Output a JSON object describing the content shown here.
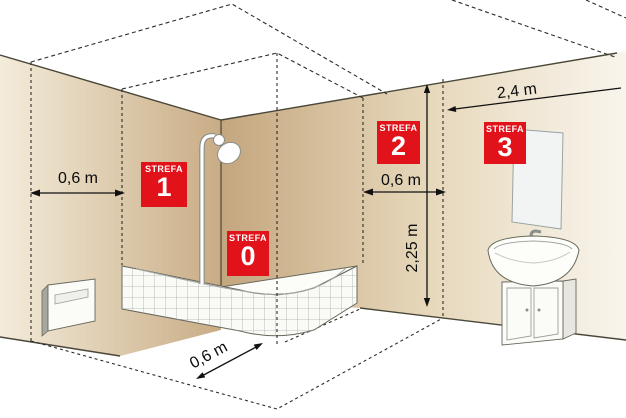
{
  "diagram": {
    "description": "Bathroom electrical safety zones (strefa 0-3) perspective diagram",
    "zone_labels": [
      {
        "title": "STREFA",
        "number": "0"
      },
      {
        "title": "STREFA",
        "number": "1"
      },
      {
        "title": "STREFA",
        "number": "2"
      },
      {
        "title": "STREFA",
        "number": "3"
      }
    ],
    "measurements": {
      "left_wall_zone2_width": "0,6 m",
      "right_wall_zone2_width": "0,6 m",
      "zone3_reach": "2,4 m",
      "zone_height": "2,25 m",
      "floor_zone2_depth": "0,6 m"
    },
    "fixtures": [
      "shower-tray",
      "shower-head",
      "wall-heater",
      "mirror",
      "washbasin-cabinet"
    ],
    "colors": {
      "zone_label_bg": "#e2121b",
      "zone_label_text": "#ffffff",
      "wall_dark": "#c9ac85",
      "wall_light": "#f3ecda",
      "outline": "#4a4738",
      "dimension_line": "#111111"
    }
  }
}
